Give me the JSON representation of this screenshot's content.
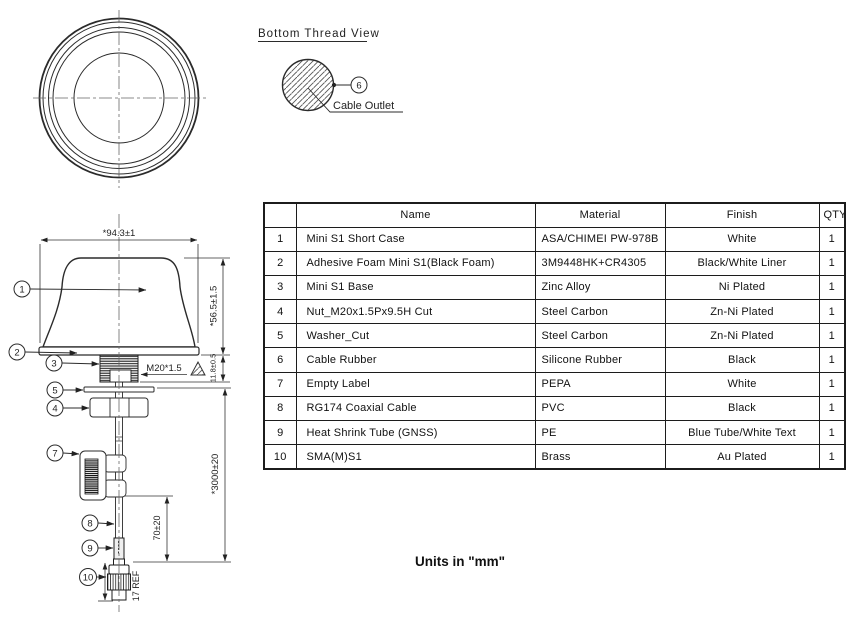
{
  "bottom_thread_view": {
    "title": "Bottom Thread View",
    "callout": "6",
    "cable_outlet_label": "Cable Outlet"
  },
  "side_view": {
    "dims": {
      "width": "*94.3±1",
      "height": "*56.5±1.5",
      "thread_height": "11.8±0.5",
      "thread_spec": "M20*1.5",
      "cable_length": "*3000±20",
      "shrink_offset": "70±20",
      "connector_length": "17 REF"
    },
    "callouts": [
      "1",
      "2",
      "3",
      "5",
      "4",
      "7",
      "8",
      "9",
      "10"
    ]
  },
  "parts_table": {
    "headers": {
      "no": "",
      "name": "Name",
      "material": "Material",
      "finish": "Finish",
      "qty": "QTY"
    },
    "rows": [
      {
        "no": "1",
        "name": "Mini S1 Short Case",
        "material": "ASA/CHIMEI PW-978B",
        "finish": "White",
        "qty": "1"
      },
      {
        "no": "2",
        "name": "Adhesive Foam Mini S1(Black Foam)",
        "material": "3M9448HK+CR4305",
        "finish": "Black/White Liner",
        "qty": "1"
      },
      {
        "no": "3",
        "name": "Mini S1 Base",
        "material": "Zinc Alloy",
        "finish": "Ni Plated",
        "qty": "1"
      },
      {
        "no": "4",
        "name": "Nut_M20x1.5Px9.5H Cut",
        "material": "Steel Carbon",
        "finish": "Zn-Ni Plated",
        "qty": "1"
      },
      {
        "no": "5",
        "name": "Washer_Cut",
        "material": "Steel Carbon",
        "finish": "Zn-Ni Plated",
        "qty": "1"
      },
      {
        "no": "6",
        "name": "Cable Rubber",
        "material": "Silicone Rubber",
        "finish": "Black",
        "qty": "1"
      },
      {
        "no": "7",
        "name": "Empty Label",
        "material": "PEPA",
        "finish": "White",
        "qty": "1"
      },
      {
        "no": "8",
        "name": "RG174 Coaxial Cable",
        "material": "PVC",
        "finish": "Black",
        "qty": "1"
      },
      {
        "no": "9",
        "name": "Heat Shrink Tube (GNSS)",
        "material": "PE",
        "finish": "Blue Tube/White Text",
        "qty": "1"
      },
      {
        "no": "10",
        "name": "SMA(M)S1",
        "material": "Brass",
        "finish": "Au Plated",
        "qty": "1"
      }
    ]
  },
  "footer": {
    "units_note": "Units in \"mm\""
  }
}
